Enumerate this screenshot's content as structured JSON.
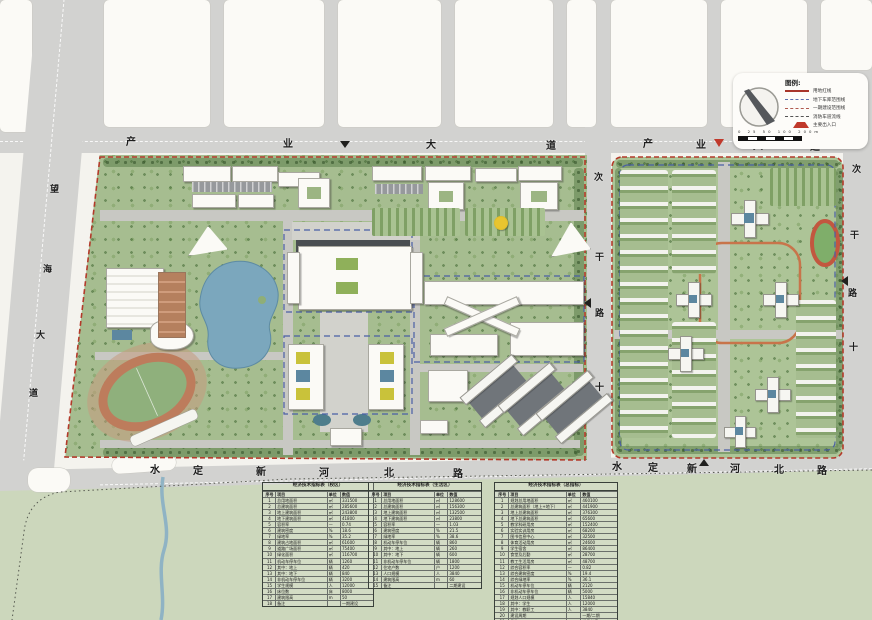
{
  "map": {
    "roads": {
      "top_west": {
        "name": "产业大道",
        "chars": [
          "产",
          "业",
          "大",
          "道"
        ]
      },
      "top_east": {
        "name": "产业大道",
        "chars": [
          "产",
          "业",
          "大",
          "道"
        ]
      },
      "left": {
        "name": "望海大道",
        "chars": [
          "望",
          "海",
          "大",
          "道"
        ]
      },
      "bottom_west": {
        "name": "水定新河北路",
        "chars": [
          "水",
          "定",
          "新",
          "河",
          "北",
          "路"
        ]
      },
      "bottom_east": {
        "name": "水定新河北路",
        "chars": [
          "水",
          "定",
          "新",
          "河",
          "北",
          "路"
        ]
      },
      "middle": {
        "name": "次干路",
        "chars": [
          "次",
          "干",
          "路",
          "十"
        ]
      },
      "right": {
        "name": "次干路",
        "chars": [
          "次",
          "干",
          "路",
          "十"
        ]
      }
    },
    "legend": {
      "title": "图例:",
      "items": [
        {
          "style": "solid-red",
          "label": "用地红线"
        },
        {
          "style": "dashed-blue",
          "label": "地下车库范围线"
        },
        {
          "style": "dashed-red",
          "label": "一期建设范围线"
        },
        {
          "style": "dashed-dark",
          "label": "消防车道流线"
        },
        {
          "style": "triangle",
          "label": "主要出入口"
        }
      ],
      "scale_numbers": "0 25 50 100 200m"
    },
    "colors": {
      "boundary_red": "#b33a2a",
      "underground_blue": "#4a5fa5",
      "water": "#7ba7bd",
      "green": "#a6bd90",
      "road_gray": "#d2d2d0",
      "track_clay": "#bd7c5c"
    }
  },
  "tables": [
    {
      "title": "经济技术指标表（校区）",
      "columns": [
        "序号",
        "项目",
        "单位",
        "数值"
      ],
      "rows": [
        [
          "1",
          "总用地面积",
          "㎡",
          "331500"
        ],
        [
          "2",
          "总建筑面积",
          "㎡",
          "285600"
        ],
        [
          "3",
          "地上建筑面积",
          "㎡",
          "243800"
        ],
        [
          "4",
          "地下建筑面积",
          "㎡",
          "41800"
        ],
        [
          "5",
          "容积率",
          "—",
          "0.74"
        ],
        [
          "6",
          "建筑密度",
          "%",
          "18.6"
        ],
        [
          "7",
          "绿地率",
          "%",
          "35.2"
        ],
        [
          "8",
          "建筑占地面积",
          "㎡",
          "61600"
        ],
        [
          "9",
          "道路广场面积",
          "㎡",
          "75400"
        ],
        [
          "10",
          "绿化面积",
          "㎡",
          "116700"
        ],
        [
          "11",
          "机动车停车位",
          "辆",
          "1260"
        ],
        [
          "12",
          "其中：地上",
          "辆",
          "420"
        ],
        [
          "13",
          "其中：地下",
          "辆",
          "840"
        ],
        [
          "14",
          "非机动车停车位",
          "辆",
          "3200"
        ],
        [
          "15",
          "学生规模",
          "人",
          "12000"
        ],
        [
          "16",
          "床位数",
          "床",
          "8000"
        ],
        [
          "17",
          "建筑限高",
          "m",
          "50"
        ],
        [
          "18",
          "备注",
          "",
          "一期建设"
        ]
      ]
    },
    {
      "title": "经济技术指标表（生活区）",
      "columns": [
        "序号",
        "项目",
        "单位",
        "数值"
      ],
      "rows": [
        [
          "1",
          "总用地面积",
          "㎡",
          "128600"
        ],
        [
          "2",
          "总建筑面积",
          "㎡",
          "156300"
        ],
        [
          "3",
          "地上建筑面积",
          "㎡",
          "132500"
        ],
        [
          "4",
          "地下建筑面积",
          "㎡",
          "23800"
        ],
        [
          "5",
          "容积率",
          "—",
          "1.03"
        ],
        [
          "6",
          "建筑密度",
          "%",
          "21.5"
        ],
        [
          "7",
          "绿地率",
          "%",
          "38.6"
        ],
        [
          "8",
          "机动车停车位",
          "辆",
          "860"
        ],
        [
          "9",
          "其中：地上",
          "辆",
          "260"
        ],
        [
          "10",
          "其中：地下",
          "辆",
          "600"
        ],
        [
          "11",
          "非机动车停车位",
          "辆",
          "1800"
        ],
        [
          "12",
          "住宅户数",
          "户",
          "1200"
        ],
        [
          "13",
          "人口规模",
          "人",
          "3840"
        ],
        [
          "14",
          "建筑限高",
          "m",
          "60"
        ],
        [
          "15",
          "备注",
          "",
          "二期建设"
        ]
      ]
    },
    {
      "title": "经济技术指标表（总指标）",
      "columns": [
        "序号",
        "项目",
        "单位",
        "数值"
      ],
      "rows": [
        [
          "1",
          "规划总用地面积",
          "㎡",
          "460100"
        ],
        [
          "2",
          "总建筑面积（地上+地下）",
          "㎡",
          "441900"
        ],
        [
          "3",
          "地上总建筑面积",
          "㎡",
          "376300"
        ],
        [
          "4",
          "地下总建筑面积",
          "㎡",
          "65600"
        ],
        [
          "5",
          "教学科研用房",
          "㎡",
          "152400"
        ],
        [
          "6",
          "实验实训用房",
          "㎡",
          "68200"
        ],
        [
          "7",
          "图书信息中心",
          "㎡",
          "32500"
        ],
        [
          "8",
          "体育活动用房",
          "㎡",
          "24600"
        ],
        [
          "9",
          "学生宿舍",
          "㎡",
          "86400"
        ],
        [
          "10",
          "食堂及后勤",
          "㎡",
          "28700"
        ],
        [
          "11",
          "教工生活用房",
          "㎡",
          "48700"
        ],
        [
          "12",
          "综合容积率",
          "—",
          "0.82"
        ],
        [
          "13",
          "综合建筑密度",
          "%",
          "19.4"
        ],
        [
          "14",
          "综合绿地率",
          "%",
          "36.1"
        ],
        [
          "15",
          "机动车停车位",
          "辆",
          "2120"
        ],
        [
          "16",
          "非机动车停车位",
          "辆",
          "5000"
        ],
        [
          "17",
          "规划人口规模",
          "人",
          "15840"
        ],
        [
          "18",
          "其中：学生",
          "人",
          "12000"
        ],
        [
          "19",
          "其中：教职工",
          "人",
          "3840"
        ],
        [
          "20",
          "建设周期",
          "",
          "一期/二期"
        ],
        [
          "21",
          "备注",
          "",
          "详见分表"
        ]
      ]
    }
  ]
}
